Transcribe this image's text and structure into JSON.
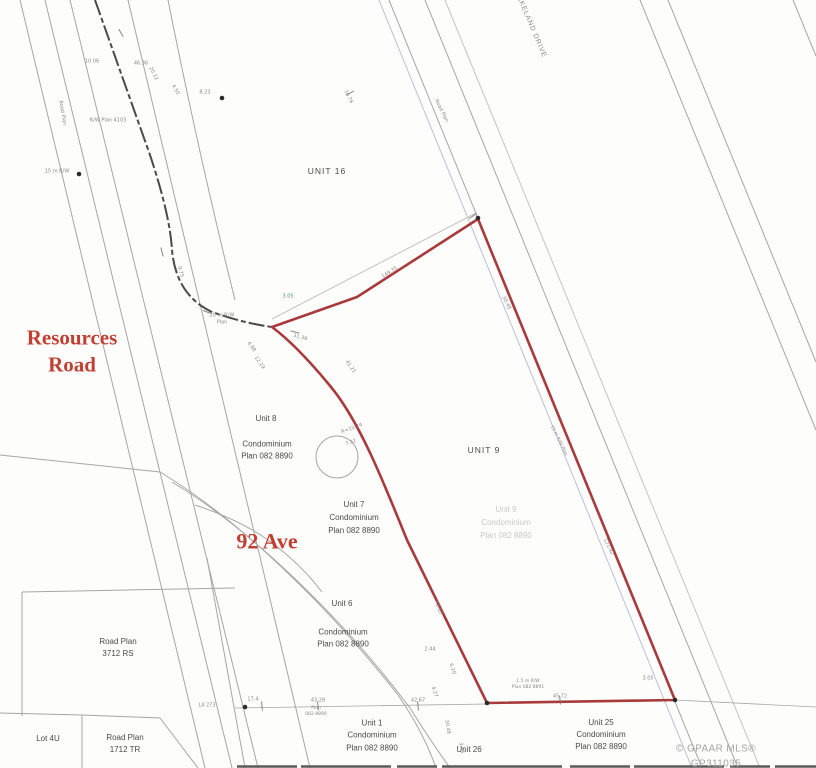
{
  "colors": {
    "boundary": "#a83a3c",
    "road_label": "#c23f33",
    "line": "#a6a6a6",
    "faint_line": "#c4c4c4",
    "dark_line": "#4a4a4a",
    "blue_line": "#b7c3d4",
    "ghost": "#c9c9c9",
    "annotation": "#8a8a8a",
    "green": "#4f9f55",
    "watermark": "#a5a5a5",
    "dot": "#2b2b2b"
  },
  "map": {
    "labels": [
      {
        "name": "resources-road-label",
        "text": "Resources\nRoad",
        "x": 72,
        "y": 352,
        "size": 21,
        "cls": "serif"
      },
      {
        "name": "92-ave-label",
        "text": "92 Ave",
        "x": 267,
        "y": 542,
        "size": 22,
        "cls": "serif"
      },
      {
        "name": "unit-16-label",
        "text": "UNIT 16",
        "x": 327,
        "y": 171,
        "size": 8.5,
        "spacing": 1
      },
      {
        "name": "unit-9-label",
        "text": "UNIT 9",
        "x": 484,
        "y": 450,
        "size": 8.5,
        "spacing": 1
      },
      {
        "name": "unit-8-label",
        "text": "Unit 8",
        "x": 266,
        "y": 419,
        "size": 8
      },
      {
        "name": "unit-8-plan-label",
        "text": "Condominium\nPlan 082 8890",
        "x": 267,
        "y": 451,
        "size": 8,
        "lh": 1.55
      },
      {
        "name": "unit-7-label",
        "text": "Unit 7\nCondominium\nPlan 082 8890",
        "x": 354,
        "y": 518,
        "size": 8,
        "lh": 1.6
      },
      {
        "name": "unit-9-ghost-label",
        "text": "Unit 9\nCondominium\nPlan 082 8890",
        "x": 506,
        "y": 523,
        "size": 8,
        "lh": 1.6,
        "cls": "ghost"
      },
      {
        "name": "unit-6-label",
        "text": "Unit 6",
        "x": 342,
        "y": 604,
        "size": 8
      },
      {
        "name": "unit-6-plan-label",
        "text": "Condominium\nPlan 082 8890",
        "x": 343,
        "y": 639,
        "size": 8,
        "lh": 1.55
      },
      {
        "name": "unit-1-label",
        "text": "Unit 1\nCondominium\nPlan 082 8890",
        "x": 372,
        "y": 736,
        "size": 8,
        "lh": 1.55
      },
      {
        "name": "unit-26-label",
        "text": "Unit 26",
        "x": 469,
        "y": 750,
        "size": 8
      },
      {
        "name": "unit-25-label",
        "text": "Unit 25\nCondominium\nPlan 082 8890",
        "x": 601,
        "y": 735,
        "size": 8,
        "lh": 1.5
      },
      {
        "name": "road-plan-3712-label",
        "text": "Road Plan\n3712 RS",
        "x": 118,
        "y": 648,
        "size": 8,
        "lh": 1.5
      },
      {
        "name": "lot-4u-label",
        "text": "Lot 4U",
        "x": 48,
        "y": 739,
        "size": 8
      },
      {
        "name": "road-plan-1712-label",
        "text": "Road Plan\n1712 TR",
        "x": 125,
        "y": 744,
        "size": 8,
        "lh": 1.5
      },
      {
        "name": "lakeland-drive-label",
        "text": "LAKELAND DRIVE",
        "x": 530,
        "y": 25,
        "size": 7,
        "rot": 67,
        "spacing": 0.8,
        "cls": "gray"
      },
      {
        "name": "mls-watermark",
        "text": "© GPAAR MLS® GP311035",
        "x": 716,
        "y": 757,
        "size": 10,
        "cls": "watermark"
      }
    ],
    "annotations": [
      {
        "x": 92,
        "y": 62,
        "t": "10.06"
      },
      {
        "x": 141,
        "y": 64,
        "t": "46.36"
      },
      {
        "x": 153,
        "y": 74,
        "t": "20.12",
        "r": 62
      },
      {
        "x": 175,
        "y": 90,
        "t": "4.50",
        "r": 62
      },
      {
        "x": 108,
        "y": 121,
        "t": "R/W Plan 4103"
      },
      {
        "x": 62,
        "y": 113,
        "t": "Road Plan",
        "r": 80
      },
      {
        "x": 57,
        "y": 172,
        "t": "15 m R/W"
      },
      {
        "x": 205,
        "y": 93,
        "t": "8.23"
      },
      {
        "x": 180,
        "y": 272,
        "t": "9.75",
        "r": 75
      },
      {
        "x": 222,
        "y": 319,
        "t": "20 m R/W\nPlan"
      },
      {
        "x": 251,
        "y": 347,
        "t": "4.88",
        "r": 55
      },
      {
        "x": 259,
        "y": 363,
        "t": "12.19",
        "r": 55
      },
      {
        "x": 288,
        "y": 297,
        "t": "3.05",
        "c": "green"
      },
      {
        "x": 390,
        "y": 273,
        "t": "149.35",
        "r": -33
      },
      {
        "x": 348,
        "y": 97,
        "t": "16.76",
        "r": 64
      },
      {
        "x": 441,
        "y": 111,
        "t": "Road Plan",
        "r": 64
      },
      {
        "x": 506,
        "y": 303,
        "t": "30.48",
        "r": 64
      },
      {
        "x": 558,
        "y": 441,
        "t": "15 m R/W Plan",
        "r": 64,
        "s": 4.5
      },
      {
        "x": 608,
        "y": 547,
        "t": "121.92",
        "r": 64
      },
      {
        "x": 352,
        "y": 429,
        "t": "R=15.24",
        "r": -20
      },
      {
        "x": 351,
        "y": 443,
        "t": "7.32",
        "r": -20
      },
      {
        "x": 350,
        "y": 367,
        "t": "41.21",
        "r": 55
      },
      {
        "x": 300,
        "y": 338,
        "t": "31.39",
        "r": 15
      },
      {
        "x": 438,
        "y": 608,
        "t": "42.67",
        "r": 72
      },
      {
        "x": 430,
        "y": 650,
        "t": "2.44"
      },
      {
        "x": 452,
        "y": 669,
        "t": "6.10",
        "r": 72
      },
      {
        "x": 434,
        "y": 692,
        "t": "4.27",
        "r": 72
      },
      {
        "x": 447,
        "y": 727,
        "t": "30.48",
        "r": 80
      },
      {
        "x": 461,
        "y": 748,
        "t": "3.05",
        "r": 80
      },
      {
        "x": 528,
        "y": 685,
        "t": "1.5 m R/W\nPlan 082 8891",
        "s": 4.5
      },
      {
        "x": 648,
        "y": 679,
        "t": "3.05"
      },
      {
        "x": 253,
        "y": 700,
        "t": "17.4"
      },
      {
        "x": 318,
        "y": 701,
        "t": "43.28"
      },
      {
        "x": 418,
        "y": 701,
        "t": "42.67"
      },
      {
        "x": 560,
        "y": 697,
        "t": "45.72"
      },
      {
        "x": 207,
        "y": 706,
        "t": "L4 273"
      },
      {
        "x": 316,
        "y": 712,
        "t": "Plan\n082 8890",
        "s": 4.5
      }
    ],
    "ticks": [
      {
        "x": 121,
        "y": 33,
        "r": 62
      },
      {
        "x": 162,
        "y": 252,
        "r": 75
      },
      {
        "x": 350,
        "y": 93,
        "r": -26
      },
      {
        "x": 473,
        "y": 216,
        "r": -33
      },
      {
        "x": 262,
        "y": 706,
        "r": 85
      },
      {
        "x": 318,
        "y": 706,
        "r": 85
      },
      {
        "x": 418,
        "y": 706,
        "r": 85
      },
      {
        "x": 560,
        "y": 700,
        "r": 85
      },
      {
        "x": 207,
        "y": 312,
        "r": 20
      },
      {
        "x": 295,
        "y": 332,
        "r": 15
      }
    ],
    "dots": [
      {
        "x": 222,
        "y": 98
      },
      {
        "x": 79,
        "y": 174
      },
      {
        "x": 245,
        "y": 707
      },
      {
        "x": 487,
        "y": 703
      },
      {
        "x": 675,
        "y": 700
      },
      {
        "x": 478,
        "y": 218
      }
    ]
  }
}
